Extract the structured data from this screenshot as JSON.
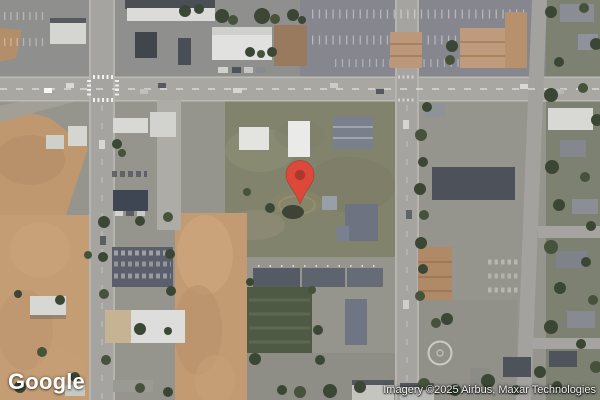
{
  "branding": {
    "logo_text": "Google"
  },
  "attribution": {
    "text": "Imagery ©2025 Airbus, Maxar Technologies"
  },
  "map": {
    "marker": {
      "color": "#DD483A",
      "inner_color": "#A93A2C",
      "outline_color": "#96301F"
    }
  }
}
